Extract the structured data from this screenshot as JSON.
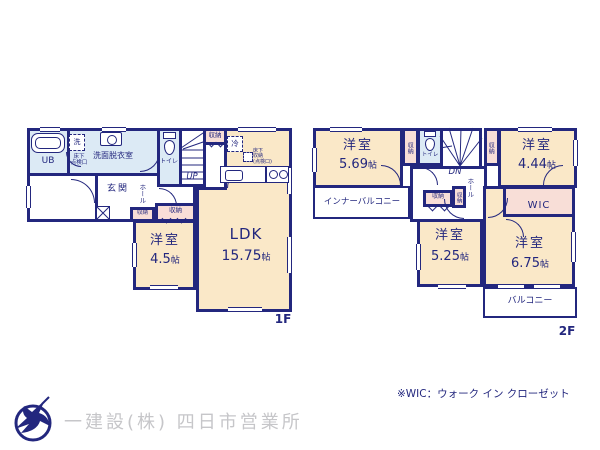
{
  "colors": {
    "wall": "#23277e",
    "room": "#fae8c8",
    "wet": "#dceaf5",
    "closet": "#f8ded7",
    "gray": "#c6c6c9"
  },
  "labels": {
    "storage": "収納",
    "toilet": "トイレ",
    "hall": "ホール",
    "western_room": "洋室",
    "size_unit": "帖"
  },
  "floor1": {
    "floor_label": "1F",
    "ub": "UB",
    "laundry": "洗",
    "hatch_line1": "床下",
    "hatch_line2": "点検口",
    "washroom": "洗面脱衣室",
    "up": "UP",
    "entrance": "玄関",
    "fridge": "冷",
    "underfloor_line1": "床下",
    "underfloor_line2": "収納",
    "underfloor_line3": "(点検口)",
    "room_west_size": "4.5",
    "ldk_name": "LDK",
    "ldk_size": "15.75"
  },
  "floor2": {
    "floor_label": "2F",
    "dn": "DN",
    "wic": "WIC",
    "inner_balcony": "インナーバルコニー",
    "balcony": "バルコニー",
    "room_nw_size": "5.69",
    "room_ne_size": "4.44",
    "room_s_size": "5.25",
    "room_se_size": "6.75"
  },
  "note": "※WIC：ウォーク イン クローゼット",
  "footer": {
    "company": "一建設(株) 四日市営業所"
  }
}
